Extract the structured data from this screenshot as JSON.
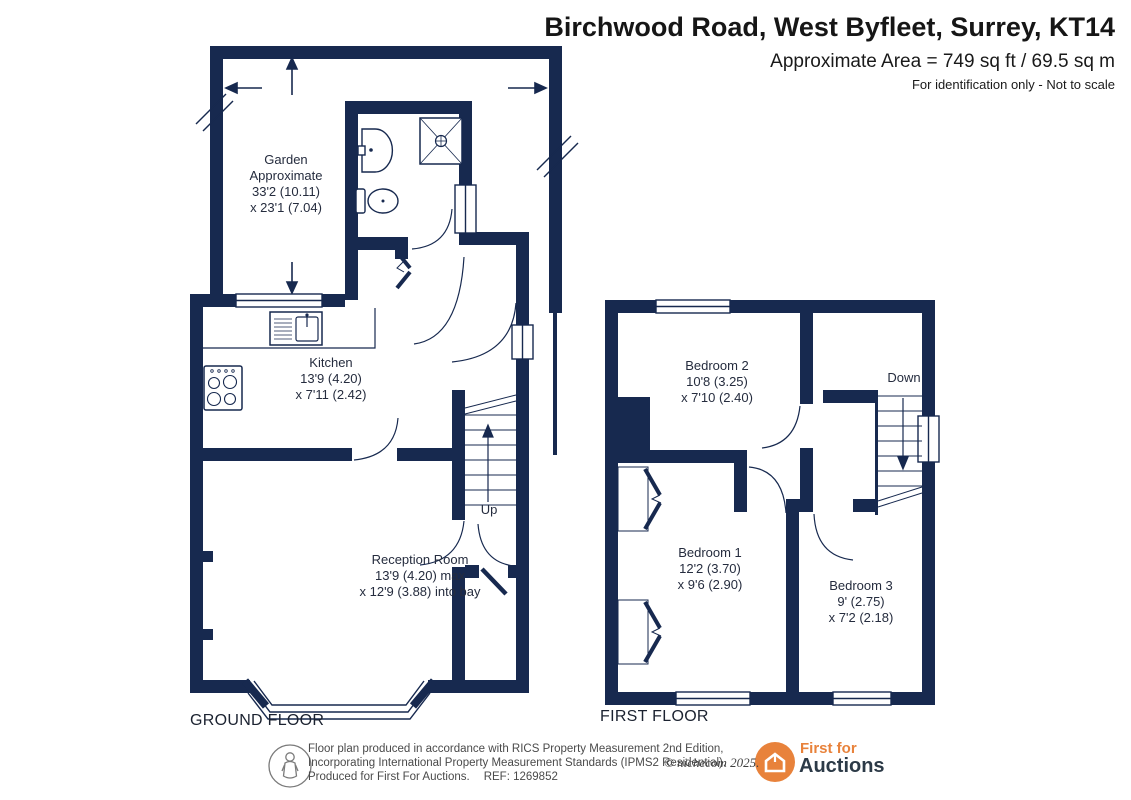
{
  "header": {
    "title": "Birchwood Road, West Byfleet, Surrey, KT14",
    "area_line": "Approximate Area = 749 sq ft / 69.5 sq m",
    "note_line": "For identification only - Not to scale"
  },
  "ground_floor": {
    "floor_label": "GROUND FLOOR",
    "garden": [
      "Garden",
      "Approximate",
      "33'2 (10.11)",
      "x 23'1 (7.04)"
    ],
    "kitchen": [
      "Kitchen",
      "13'9 (4.20)",
      "x 7'11 (2.42)"
    ],
    "reception": [
      "Reception Room",
      "13'9 (4.20) max",
      "x 12'9 (3.88) into bay"
    ],
    "stairs_label": "Up"
  },
  "first_floor": {
    "floor_label": "FIRST FLOOR",
    "bedroom2": [
      "Bedroom 2",
      "10'8 (3.25)",
      "x 7'10 (2.40)"
    ],
    "bedroom1": [
      "Bedroom 1",
      "12'2 (3.70)",
      "x 9'6 (2.90)"
    ],
    "bedroom3": [
      "Bedroom 3",
      "9' (2.75)",
      "x 7'2 (2.18)"
    ],
    "stairs_label": "Down"
  },
  "footer": {
    "disclaimer_line1": "Floor plan produced in accordance with RICS Property Measurement 2nd Edition,",
    "disclaimer_line2": "Incorporating International Property Measurement Standards (IPMS2 Residential).",
    "disclaimer_line3": "Produced for First For Auctions.",
    "ref": "REF: 1269852",
    "copyright": "© nichecom 2025.",
    "brand": {
      "line1": "First for",
      "line2": "Auctions"
    }
  },
  "icons": {
    "measurer_icon": "person-outline-in-circle",
    "brand_icon": "house-in-orange-circle",
    "stairs_up_arrow": "arrow-up",
    "stairs_down_arrow": "arrow-down",
    "garden_extent_arrows": "direction-arrows"
  },
  "colors": {
    "wall_navy": "#17294f",
    "brand_orange": "#e8823b",
    "label_text": "#252c3e"
  }
}
